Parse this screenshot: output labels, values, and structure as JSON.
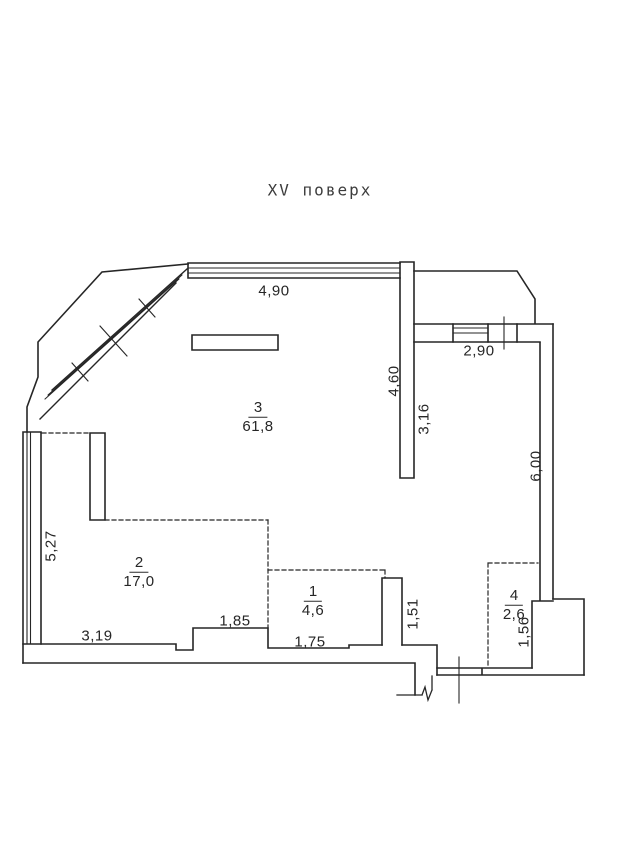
{
  "title": "XV поверх",
  "rooms": [
    {
      "number": "3",
      "area": "61,8"
    },
    {
      "number": "2",
      "area": "17,0"
    },
    {
      "number": "1",
      "area": "4,6"
    },
    {
      "number": "4",
      "area": "2,6"
    }
  ],
  "dimensions": {
    "top_width": "4,90",
    "balcony_room_width": "2,90",
    "room3_right_height": "4,60",
    "right_room_height": "3,16",
    "right_wall_height": "6,00",
    "left_wall_height": "5,27",
    "bottom_left_width": "3,19",
    "niche_width": "1,85",
    "room1_width": "1,75",
    "room1_right_height": "1,51",
    "room4_height": "1,56"
  },
  "colors": {
    "line": "#262626",
    "background": "#ffffff"
  }
}
